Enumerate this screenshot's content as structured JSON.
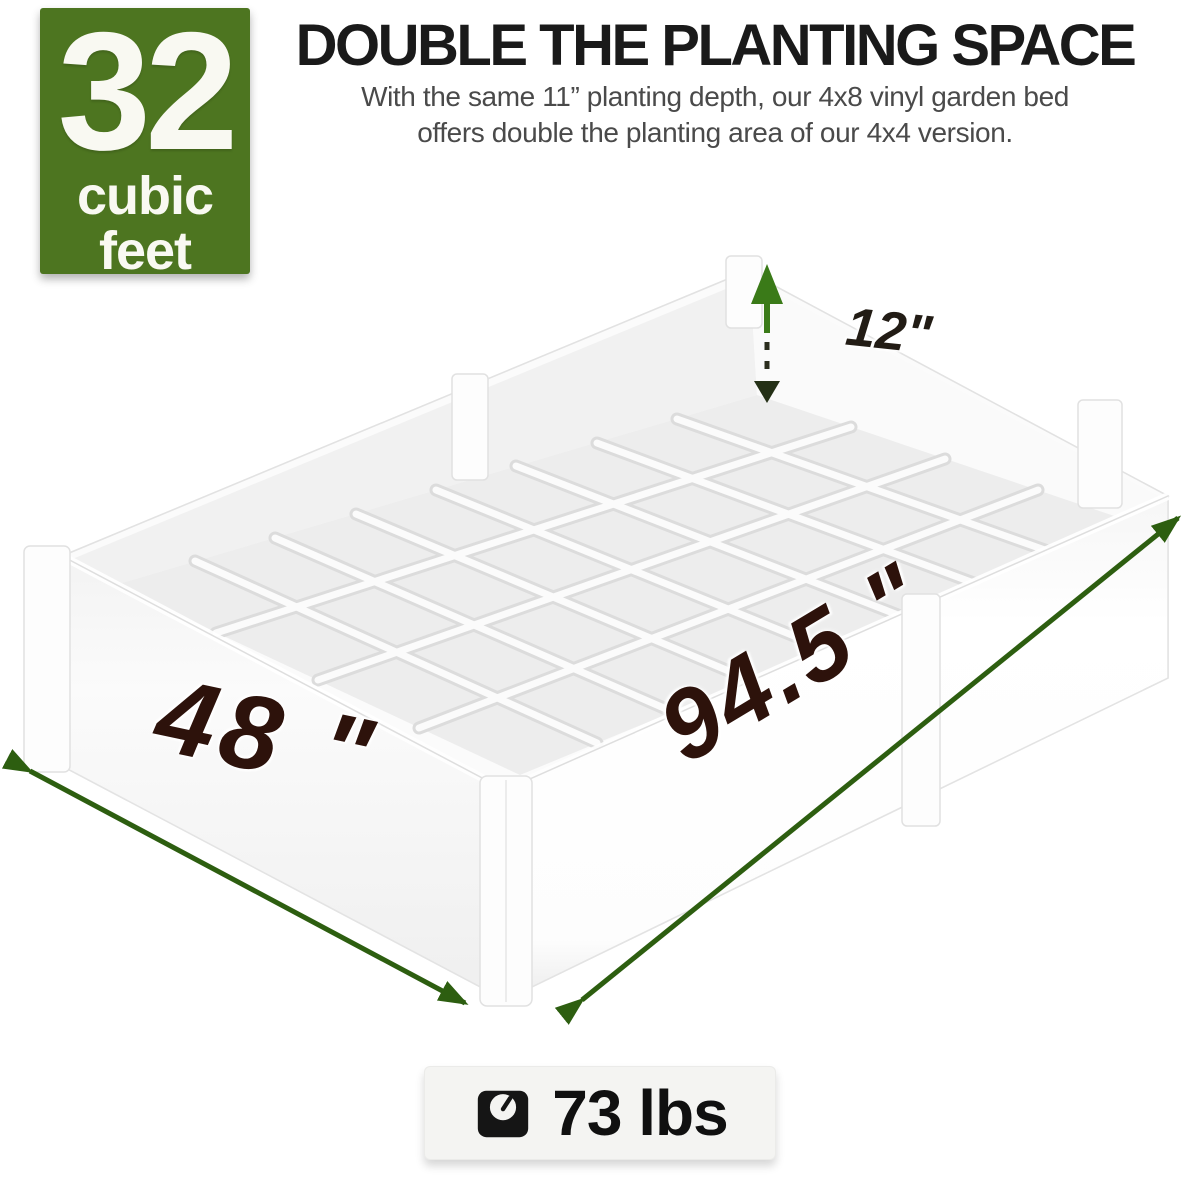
{
  "badge": {
    "number": "32",
    "unit_line1": "cubic",
    "unit_line2": "feet",
    "background_color": "#4d7520"
  },
  "header": {
    "title": "DOUBLE THE PLANTING SPACE",
    "subtitle_line1": "With the same 11” planting depth, our 4x8 vinyl garden bed",
    "subtitle_line2": "offers double the planting area of our 4x4 version."
  },
  "dimensions": {
    "depth": "12\"",
    "width": "48 \"",
    "length": "94.5 \"",
    "arrow_color": "#2d5e10",
    "label_color": "#2d120b"
  },
  "weight": {
    "value": "73 lbs",
    "icon": "weight-scale-icon"
  }
}
